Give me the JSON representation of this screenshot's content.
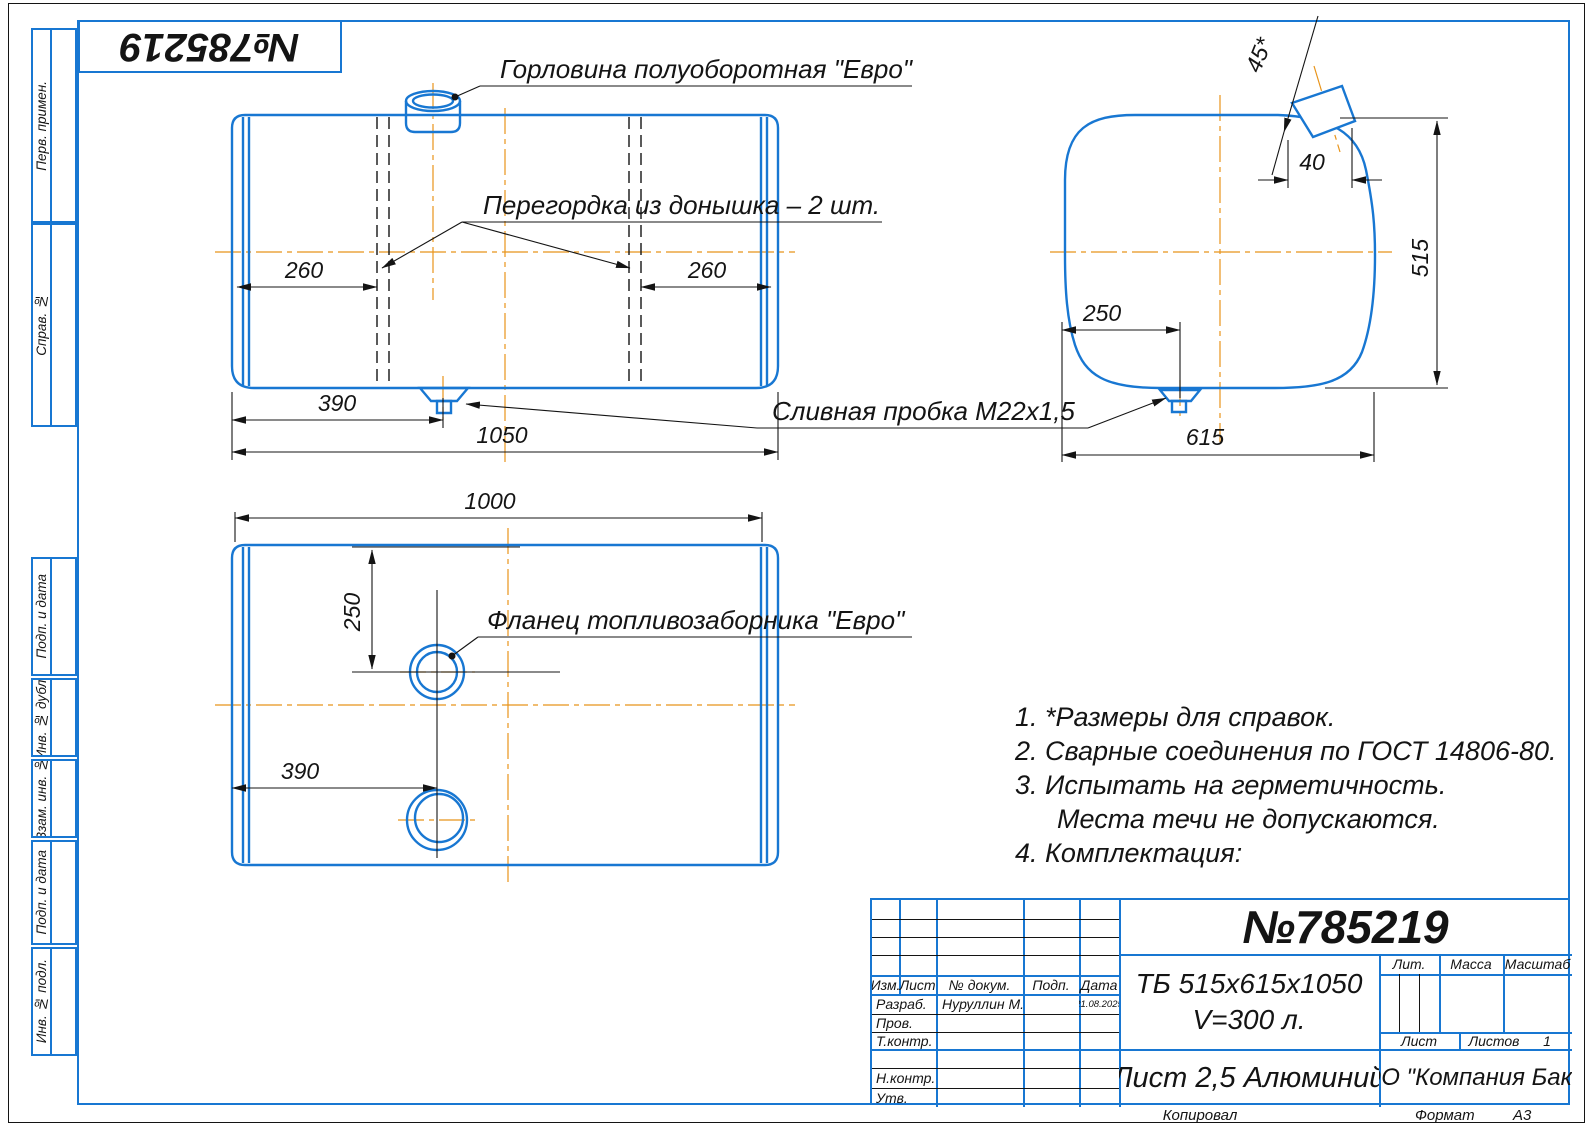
{
  "doc_number": "№785219",
  "margin": {
    "labels": [
      "Перв. примен.",
      "Справ. №",
      "Подп. и дата",
      "Инв. № дубл.",
      "Взам. инв. №",
      "Подп. и дата",
      "Инв. № подл."
    ]
  },
  "annotations": {
    "neck": "Горловина полуоборотная \"Евро\"",
    "baffle": "Перегордка из донышка – 2 шт.",
    "drain": "Сливная пробка М22х1,5",
    "flange": "Фланец топливозаборника \"Евро\""
  },
  "dims": {
    "front_260_left": "260",
    "front_260_right": "260",
    "front_390": "390",
    "front_1050": "1050",
    "bottom_1000": "1000",
    "bottom_250": "250",
    "bottom_390": "390",
    "side_45": "45*",
    "side_40": "40",
    "side_515": "515",
    "side_250": "250",
    "side_615": "615"
  },
  "notes": {
    "line1": "1. *Размеры для справок.",
    "line2": "2. Сварные соединения по ГОСТ 14806-80.",
    "line3": "3. Испытать на герметичность.",
    "line4": "Места течи не допускаются.",
    "line5": "4. Комплектация:"
  },
  "title_block": {
    "designation": "ТБ 515х615х1050",
    "volume": "V=300 л.",
    "material": "Лист 2,5 Алюминий",
    "company": "ООО \"Компания Бакор\"",
    "headers": {
      "izm": "Изм.",
      "list": "Лист",
      "doc": "№ докум.",
      "podp": "Подп.",
      "data": "Дата"
    },
    "rows": {
      "r1": {
        "label": "Разраб.",
        "name": "Нуруллин М.И.",
        "date": "21.08.2025"
      },
      "r2": {
        "label": "Пров."
      },
      "r3": {
        "label": "Т.контр."
      },
      "r4": {
        "label": "Н.контр."
      },
      "r5": {
        "label": "Утв."
      }
    },
    "lit_label": "Лит.",
    "massa_label": "Масса",
    "masshtab_label": "Масштаб",
    "list_label": "Лист",
    "listov_label": "Листов",
    "listov_value": "1",
    "footer_copy": "Копировал",
    "footer_format": "Формат",
    "format_value": "А3"
  },
  "colors": {
    "line_blue": "#1877d2",
    "centerline_orange": "#e8941a",
    "ink": "#141414"
  }
}
